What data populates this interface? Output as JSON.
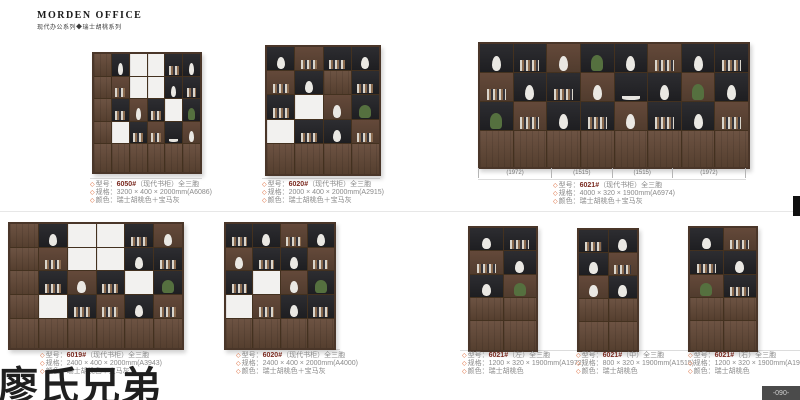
{
  "page": {
    "brand": "MORDEN OFFICE",
    "subtitle": "现代办公系列◆瑞士胡桃系列",
    "watermark": "廖氏兄弟",
    "page_number": "-090-"
  },
  "labels": {
    "bullet": "◇",
    "model": "型号：",
    "size": "规格：",
    "color": "颜色："
  },
  "colors": {
    "accent_bullet": "#d95f2b",
    "model_text": "#7a2a20",
    "caption_text": "#8a8a8a",
    "wood": "#5e4636",
    "dark_cell": "#26262a"
  },
  "products": [
    {
      "id": "p1",
      "model": "6050#",
      "desc": "（现代书柜）全三胞",
      "size": "3200 × 400 × 2000mm(A6086)",
      "color": "瑞士胡桃色＋宝马灰",
      "art": {
        "cols": 6,
        "cells": [
          [
            "w",
            "dv",
            "wh",
            "wh",
            "db",
            "dv"
          ],
          [
            "w",
            "sb",
            "wh",
            "wh",
            "dv",
            "db"
          ],
          [
            "w",
            "db",
            "sv",
            "db",
            "wh",
            "dp"
          ],
          [
            "w",
            "wh",
            "db",
            "sb",
            "do",
            "sv"
          ],
          [
            "w",
            "w",
            "w",
            "w",
            "w",
            "w"
          ]
        ]
      }
    },
    {
      "id": "p2",
      "model": "6020#",
      "desc": "（现代书柜）全三胞",
      "size": "2000 × 400 × 2000mm(A2915)",
      "color": "瑞士胡桃色＋宝马灰",
      "art": {
        "cols": 4,
        "cells": [
          [
            "dv",
            "sb",
            "db",
            "dv"
          ],
          [
            "sb",
            "dv",
            "w",
            "db"
          ],
          [
            "db",
            "wh",
            "sv",
            "dp"
          ],
          [
            "wh",
            "db",
            "dv",
            "sb"
          ],
          [
            "w",
            "w",
            "w",
            "w"
          ]
        ]
      }
    },
    {
      "id": "p3",
      "model": "6021#",
      "desc": "（现代书柜）全三胞",
      "size": "4000 × 320 × 1900mm(A6974)",
      "color": "瑞士胡桃色＋宝马灰",
      "segments": [
        "(1972)",
        "(1515)",
        "(1515)",
        "(1972)"
      ],
      "segment_widths": [
        1972,
        1515,
        1515,
        1972
      ],
      "art": {
        "cols": 8,
        "cells": [
          [
            "dv",
            "db",
            "sv",
            "dp",
            "dv",
            "sb",
            "dv",
            "db"
          ],
          [
            "sb",
            "dv",
            "db",
            "sv",
            "do",
            "dv",
            "sp",
            "dv"
          ],
          [
            "dp",
            "sb",
            "dv",
            "db",
            "sv",
            "db",
            "dv",
            "sb"
          ],
          [
            "w",
            "w",
            "w",
            "w",
            "w",
            "w",
            "w",
            "w"
          ]
        ]
      }
    },
    {
      "id": "p4",
      "model": "6019#",
      "desc": "（现代书柜）全三胞",
      "size": "2400 × 400 × 2000mm(A3943)",
      "color": "瑞士胡桃色＋宝马灰",
      "art": {
        "cols": 6,
        "cells": [
          [
            "w",
            "dv",
            "wh",
            "wh",
            "db",
            "sv"
          ],
          [
            "w",
            "sb",
            "wh",
            "wh",
            "dv",
            "db"
          ],
          [
            "w",
            "db",
            "sv",
            "db",
            "wh",
            "dp"
          ],
          [
            "w",
            "wh",
            "db",
            "sb",
            "dv",
            "sb"
          ],
          [
            "w",
            "w",
            "w",
            "w",
            "w",
            "w"
          ]
        ]
      }
    },
    {
      "id": "p5",
      "model": "6020#",
      "desc": "（现代书柜）全三胞",
      "size": "2400 × 400 × 2000mm(A4000)",
      "color": "瑞士胡桃色＋宝马灰",
      "art": {
        "cols": 4,
        "cells": [
          [
            "db",
            "dv",
            "sb",
            "dv"
          ],
          [
            "sv",
            "db",
            "dv",
            "sb"
          ],
          [
            "db",
            "wh",
            "sv",
            "dp"
          ],
          [
            "wh",
            "sb",
            "dv",
            "db"
          ],
          [
            "w",
            "w",
            "w",
            "w"
          ]
        ]
      }
    },
    {
      "id": "p6",
      "model": "6021#",
      "desc": "（左）全三胞",
      "size": "1200 × 320 × 1900mm(A1972)",
      "color": "瑞士胡桃色",
      "art": {
        "cols": 2,
        "cells": [
          [
            "dv",
            "db"
          ],
          [
            "sb",
            "dv"
          ],
          [
            "dv",
            "sp"
          ],
          [
            "w",
            "w"
          ],
          [
            "w",
            "w"
          ]
        ]
      }
    },
    {
      "id": "p7",
      "model": "6021#",
      "desc": "（中）全三胞",
      "size": "800 × 320 × 1900mm(A1515)",
      "color": "瑞士胡桃色",
      "art": {
        "cols": 2,
        "cells": [
          [
            "db",
            "dv"
          ],
          [
            "dv",
            "sb"
          ],
          [
            "sv",
            "dv"
          ],
          [
            "w",
            "w"
          ],
          [
            "w",
            "w"
          ]
        ]
      }
    },
    {
      "id": "p8",
      "model": "6021#",
      "desc": "（右）全三胞",
      "size": "1200 × 320 × 1900mm(A1972)",
      "color": "瑞士胡桃色",
      "art": {
        "cols": 2,
        "cells": [
          [
            "dv",
            "sb"
          ],
          [
            "db",
            "dv"
          ],
          [
            "sp",
            "db"
          ],
          [
            "w",
            "w"
          ],
          [
            "w",
            "w"
          ]
        ]
      }
    }
  ]
}
